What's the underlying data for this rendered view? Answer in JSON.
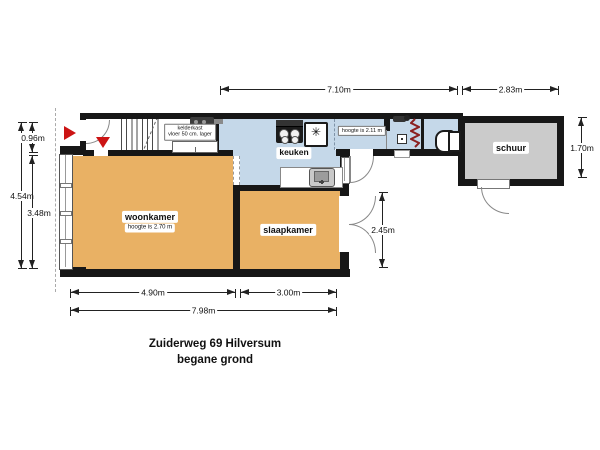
{
  "plan": {
    "title_line1": "Zuiderweg 69 Hilversum",
    "title_line2": "begane grond"
  },
  "rooms": {
    "woonkamer": {
      "label": "woonkamer",
      "height_note": "hoogte is 2.70 m"
    },
    "slaapkamer": {
      "label": "slaapkamer"
    },
    "keuken": {
      "label": "keuken"
    },
    "schuur": {
      "label": "schuur"
    },
    "hal": {
      "height_note": "hoogte is 2.11 m"
    },
    "kelderkast": {
      "label": "kelderkast",
      "note": "vloer 50 cm. lager"
    }
  },
  "dimensions": {
    "top_main": "7.10m",
    "top_shed": "2.83m",
    "left_total": "4.54m",
    "left_entry": "0.96m",
    "left_living": "3.48m",
    "right_bedroom": "2.45m",
    "right_shed": "1.70m",
    "bottom_living": "4.90m",
    "bottom_bedroom": "3.00m",
    "bottom_total": "7.98m"
  },
  "icons": {
    "freezer_glyph": "✳"
  },
  "colors": {
    "room_fill": "#e9b164",
    "wet_room_fill": "#c5d8e9",
    "shed_fill": "#cbcbcb",
    "wall": "#171717",
    "entrance_arrow": "#cc1414",
    "radiator": "#8b2020"
  }
}
